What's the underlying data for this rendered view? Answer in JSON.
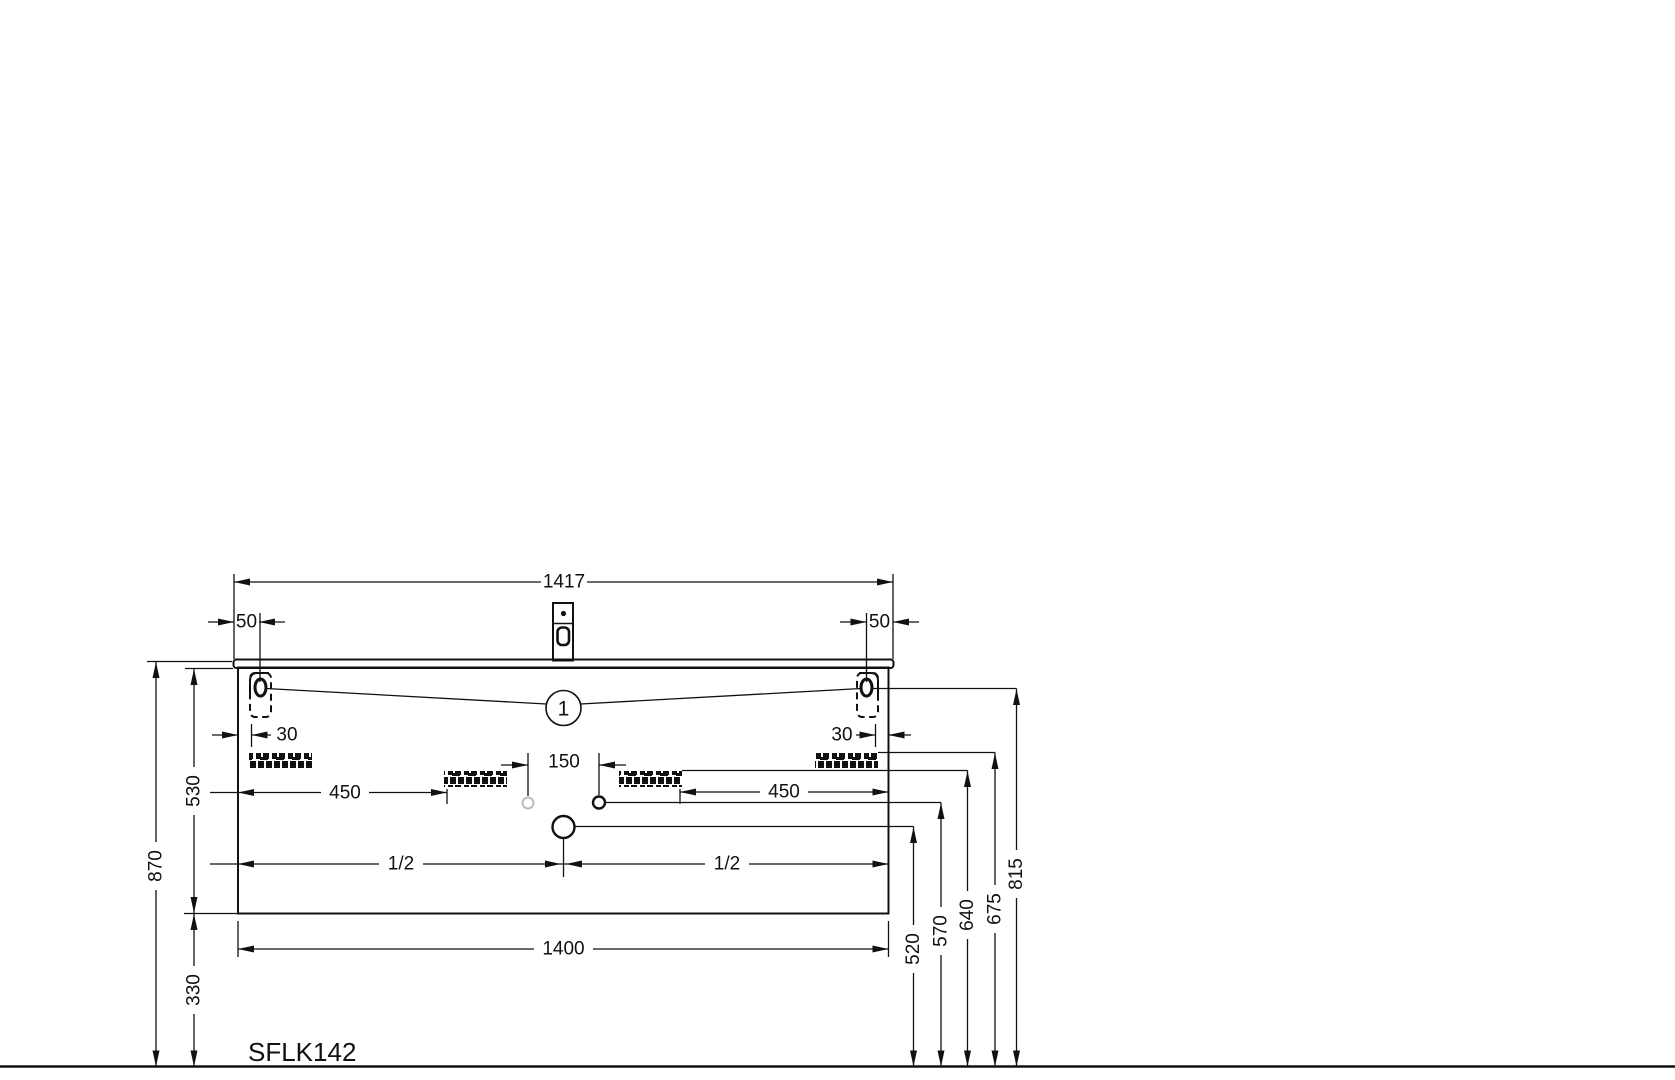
{
  "product_code": "SFLK142",
  "balloon": {
    "label": "1"
  },
  "dims": {
    "overall_width": "1417",
    "offset_left": "50",
    "offset_right": "50",
    "bracket_edge_left": "30",
    "bracket_edge_right": "30",
    "drain_spacing": "150",
    "rail_inset_left": "450",
    "rail_inset_right": "450",
    "half_left": "1/2",
    "half_right": "1/2",
    "cabinet_width": "1400",
    "height_total": "870",
    "height_cabinet": "530",
    "height_clearance": "330",
    "height_siphon": "520",
    "height_drain": "570",
    "height_rail_center": "640",
    "height_rail_outer": "675",
    "height_bracket": "815"
  },
  "colors": {
    "line": "#111111",
    "muted_circle": "#bdbdbd",
    "background": "#ffffff"
  }
}
